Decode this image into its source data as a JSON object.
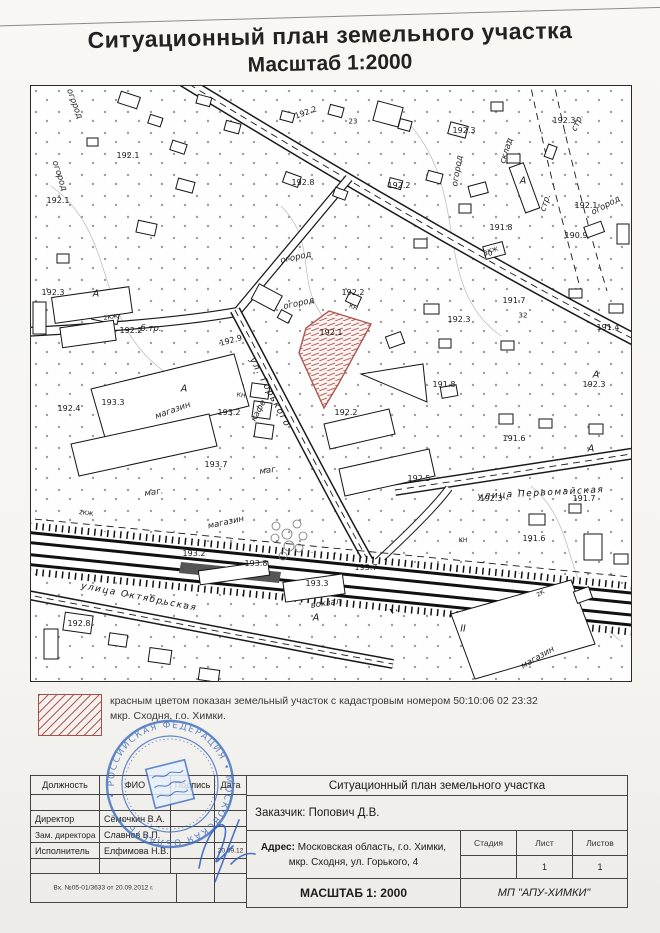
{
  "title": {
    "line1": "Ситуационный план земельного участка",
    "line2": "Масштаб 1:2000"
  },
  "legend": {
    "line1": "красным цветом показан земельный участок с кадастровым номером 50:10:06 02  23:32",
    "line2": "мкр. Сходня, г.о. Химки.",
    "hatch_color": "#b35a55",
    "parcel_border_color": "#a84f4a"
  },
  "stamp": {
    "ring_text": "• РОССИЙСКАЯ ФЕДЕРАЦИЯ • МОСКОВСКАЯ ОБЛАСТЬ •",
    "color": "#3f6fc0"
  },
  "title_block": {
    "columns": {
      "c1": "Должность",
      "c2": "ФИО",
      "c3": "Подпись",
      "c4": "Дата"
    },
    "rows": [
      {
        "role": "Директор",
        "name": "Сёмочкин В.А.",
        "date": ""
      },
      {
        "role": "Зам. директора",
        "name": "Славнов В.П.",
        "date": ""
      },
      {
        "role": "Исполнитель",
        "name": "Елфимова Н.В.",
        "date": "20.09.12"
      }
    ],
    "incoming_number": "Вх. №05-01/3633 от 20.09.2012 г.",
    "right": {
      "title": "Ситуационный план земельного участка",
      "customer": "Заказчик: Попович Д.В.",
      "address_label": "Адрес:",
      "address_line1": "Московская область, г.о. Химки,",
      "address_line2": "мкр. Сходня, ул. Горького, 4",
      "stage_label": "Стадия",
      "sheet_label": "Лист",
      "sheets_label": "Листов",
      "stage_value": "",
      "sheet_value": "1",
      "sheets_value": "1",
      "scale": "МАСШТАБ 1: 2000",
      "org": "МП \"АПУ-ХИМКИ\""
    }
  },
  "map": {
    "labels": [
      {
        "t": "192.1",
        "x": 97,
        "y": 70,
        "c": "e"
      },
      {
        "t": "192.1",
        "x": 27,
        "y": 115,
        "c": "e"
      },
      {
        "t": "192.3",
        "x": 22,
        "y": 207,
        "c": "e"
      },
      {
        "t": "192.2",
        "x": 100,
        "y": 245,
        "c": "e"
      },
      {
        "t": "192.4",
        "x": 38,
        "y": 323,
        "c": "e"
      },
      {
        "t": "193.3",
        "x": 82,
        "y": 317,
        "c": "e"
      },
      {
        "t": "193.2",
        "x": 198,
        "y": 327,
        "c": "e"
      },
      {
        "t": "193.7",
        "x": 185,
        "y": 379,
        "c": "e"
      },
      {
        "t": "192.9",
        "x": 200,
        "y": 255,
        "r": -15,
        "c": "e"
      },
      {
        "t": "192.1",
        "x": 300,
        "y": 247,
        "c": "e"
      },
      {
        "t": "192.2",
        "x": 322,
        "y": 207,
        "c": "e"
      },
      {
        "t": "192.2",
        "x": 315,
        "y": 327,
        "c": "e"
      },
      {
        "t": "192.2",
        "x": 368,
        "y": 100,
        "c": "e"
      },
      {
        "t": "192.3",
        "x": 433,
        "y": 45,
        "c": "e"
      },
      {
        "t": "192.2",
        "x": 275,
        "y": 27,
        "r": -20,
        "c": "e"
      },
      {
        "t": "192.8",
        "x": 272,
        "y": 97,
        "c": "e"
      },
      {
        "t": "190.9",
        "x": 545,
        "y": 150,
        "c": "e"
      },
      {
        "t": "192.1",
        "x": 555,
        "y": 120,
        "c": "e"
      },
      {
        "t": "192.3",
        "x": 533,
        "y": 35,
        "c": "e"
      },
      {
        "t": "191.8",
        "x": 470,
        "y": 142,
        "c": "e"
      },
      {
        "t": "191.7",
        "x": 483,
        "y": 215,
        "c": "e"
      },
      {
        "t": "192.3",
        "x": 428,
        "y": 234,
        "c": "e"
      },
      {
        "t": "191.4",
        "x": 577,
        "y": 242,
        "c": "e"
      },
      {
        "t": "191.8",
        "x": 413,
        "y": 299,
        "c": "e"
      },
      {
        "t": "192.3",
        "x": 563,
        "y": 299,
        "c": "e"
      },
      {
        "t": "191.6",
        "x": 483,
        "y": 353,
        "c": "e"
      },
      {
        "t": "192.3",
        "x": 460,
        "y": 413,
        "c": "e"
      },
      {
        "t": "191.7",
        "x": 553,
        "y": 413,
        "c": "e"
      },
      {
        "t": "191.6",
        "x": 503,
        "y": 453,
        "c": "e"
      },
      {
        "t": "192.5",
        "x": 388,
        "y": 393,
        "c": "e"
      },
      {
        "t": "193.7",
        "x": 335,
        "y": 482,
        "c": "e"
      },
      {
        "t": "193.3",
        "x": 286,
        "y": 498,
        "c": "e"
      },
      {
        "t": "193.8",
        "x": 225,
        "y": 478,
        "c": "e"
      },
      {
        "t": "193.2",
        "x": 163,
        "y": 468,
        "c": "e"
      },
      {
        "t": "192.8",
        "x": 48,
        "y": 538,
        "c": "e"
      },
      {
        "t": "огород",
        "x": 43,
        "y": 18,
        "r": 70,
        "c": "a"
      },
      {
        "t": "огород",
        "x": 28,
        "y": 90,
        "r": 72,
        "c": "a"
      },
      {
        "t": "огород",
        "x": 265,
        "y": 172,
        "r": -12,
        "c": "a"
      },
      {
        "t": "огород",
        "x": 268,
        "y": 218,
        "r": -12,
        "c": "a"
      },
      {
        "t": "огород",
        "x": 427,
        "y": 85,
        "r": -80,
        "c": "a"
      },
      {
        "t": "огород",
        "x": 575,
        "y": 120,
        "r": -28,
        "c": "a"
      },
      {
        "t": "склад",
        "x": 476,
        "y": 65,
        "r": -72,
        "c": "a"
      },
      {
        "t": "стр.",
        "x": 547,
        "y": 37,
        "r": -65,
        "c": "a"
      },
      {
        "t": "стр.",
        "x": 515,
        "y": 117,
        "r": -72,
        "c": "a"
      },
      {
        "t": "б.тр.",
        "x": 120,
        "y": 243,
        "c": "a"
      },
      {
        "t": "кафе",
        "x": 228,
        "y": 325,
        "r": -62,
        "c": "a"
      },
      {
        "t": "вокзал",
        "x": 295,
        "y": 518,
        "r": -8,
        "c": "a"
      },
      {
        "t": "магазин",
        "x": 142,
        "y": 325,
        "r": -20,
        "c": "a"
      },
      {
        "t": "магазин",
        "x": 195,
        "y": 437,
        "r": -12,
        "c": "a"
      },
      {
        "t": "магазин",
        "x": 507,
        "y": 572,
        "r": -30,
        "c": "a"
      },
      {
        "t": "маг.",
        "x": 238,
        "y": 385,
        "r": -8,
        "c": "a"
      },
      {
        "t": "маг.",
        "x": 123,
        "y": 407,
        "r": -8,
        "c": "a"
      },
      {
        "t": "ул. Горького",
        "x": 238,
        "y": 307,
        "r": 62,
        "c": "s"
      },
      {
        "t": "улица Октябрьская",
        "x": 108,
        "y": 512,
        "r": 11,
        "c": "s"
      },
      {
        "t": "улица Первомайская",
        "x": 510,
        "y": 408,
        "r": -3,
        "c": "s"
      },
      {
        "t": "2КЖ",
        "x": 80,
        "y": 232,
        "r": -8,
        "c": "b"
      },
      {
        "t": "КН",
        "x": 322,
        "y": 222,
        "r": 25,
        "c": "b"
      },
      {
        "t": "2КЖ",
        "x": 55,
        "y": 428,
        "r": 8,
        "c": "b"
      },
      {
        "t": "КН",
        "x": 210,
        "y": 310,
        "r": 8,
        "c": "b"
      },
      {
        "t": "КЖ",
        "x": 462,
        "y": 165,
        "r": -15,
        "c": "b"
      },
      {
        "t": "КН",
        "x": 432,
        "y": 455,
        "c": "b"
      },
      {
        "t": "2К",
        "x": 510,
        "y": 508,
        "r": -30,
        "c": "b"
      },
      {
        "t": "23",
        "x": 322,
        "y": 36,
        "c": "h"
      },
      {
        "t": "30",
        "x": 457,
        "y": 168,
        "c": "h"
      },
      {
        "t": "32",
        "x": 492,
        "y": 230,
        "c": "h"
      },
      {
        "t": "А",
        "x": 65,
        "y": 208,
        "c": "m"
      },
      {
        "t": "А",
        "x": 153,
        "y": 303,
        "c": "m"
      },
      {
        "t": "А",
        "x": 492,
        "y": 95,
        "c": "m"
      },
      {
        "t": "А",
        "x": 565,
        "y": 289,
        "c": "m"
      },
      {
        "t": "А",
        "x": 285,
        "y": 532,
        "c": "m"
      },
      {
        "t": "А",
        "x": 560,
        "y": 363,
        "c": "m"
      },
      {
        "t": "II",
        "x": 432,
        "y": 543,
        "c": "m"
      }
    ]
  }
}
